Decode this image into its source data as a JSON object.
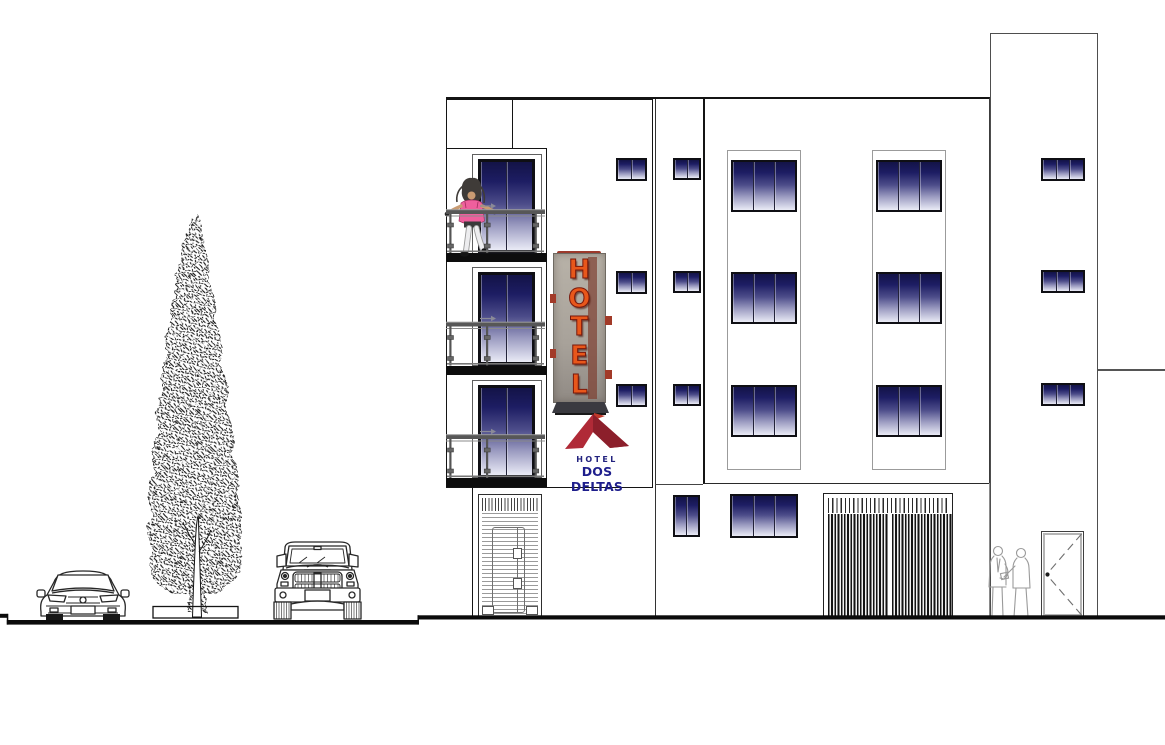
{
  "drawing": {
    "subject": "hotel-front-elevation"
  },
  "sign": {
    "letters": "HOTEL"
  },
  "logo": {
    "top": "HOTEL",
    "bottom": "DOS DELTAS"
  },
  "colors": {
    "line": "#141414",
    "soft_line": "#8a8a8a",
    "rail": "#575757",
    "glass_top": "#131347",
    "glass_mid": "#4d4d8a",
    "glass_bottom": "#eaebf6",
    "sign_panel": "#aca69c",
    "sign_letter": "#e8571b",
    "sign_accent": "#a23a28",
    "logo_red": "#b02a37",
    "logo_red_dark": "#8c1f2b",
    "logo_navy": "#23237f"
  },
  "windows": {
    "balcony": {
      "x": 478,
      "w": 57,
      "panes": 2,
      "rows": [
        {
          "y": 159,
          "h": 95
        },
        {
          "y": 271.5,
          "h": 94.5
        },
        {
          "y": 384.5,
          "h": 94
        }
      ]
    },
    "small": [
      {
        "x": 616,
        "w": 31,
        "h": 23,
        "panes": 2,
        "rows": [
          158,
          270.5,
          383.5
        ]
      },
      {
        "x": 673,
        "w": 28,
        "h": 22,
        "panes": 2,
        "rows": [
          158,
          270.5,
          383.5
        ]
      },
      {
        "x": 1041,
        "w": 44,
        "h": 23,
        "panes": 3,
        "rows": [
          158,
          270,
          383
        ]
      }
    ],
    "large": {
      "cols": [
        731,
        876
      ],
      "w": 66,
      "h": 52,
      "panes": 3,
      "rows": [
        160,
        272,
        385
      ]
    },
    "ground": [
      {
        "x": 673,
        "y": 495,
        "w": 27,
        "h": 42,
        "panes": 2
      },
      {
        "x": 730,
        "y": 494,
        "w": 68,
        "h": 44,
        "panes": 3
      }
    ]
  }
}
